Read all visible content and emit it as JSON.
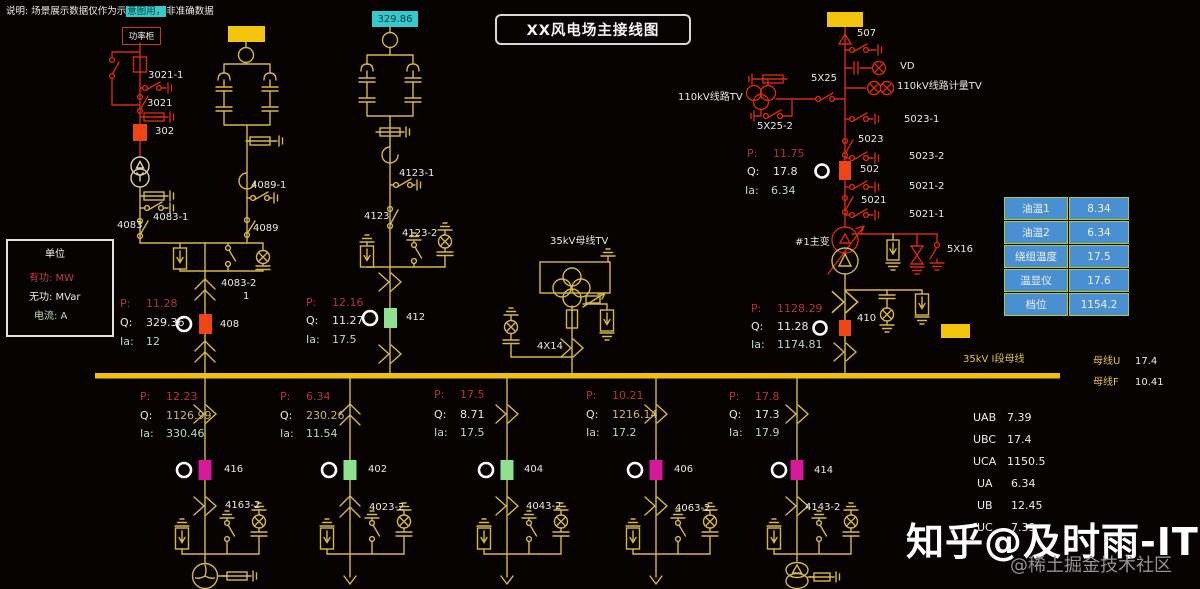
{
  "header": {
    "note_prefix": "说明: 场景展示数据仅作为示",
    "note_highlight": "意图用，",
    "note_suffix": "非准确数据",
    "title": "XX风电场主接线图",
    "capacitor_readout": "329.86",
    "power_cabinet": "功率柜"
  },
  "prefixes": {
    "p": "P:",
    "q": "Q:",
    "ia": "Ia:"
  },
  "legend": {
    "title": "单位",
    "active": "有功: MW",
    "reactive": "无功: MVar",
    "current": "电流: A"
  },
  "bay1": {
    "sw_3021_1": "3021-1",
    "sw_3021": "3021",
    "breaker_302": "302",
    "sw_4083": "4083",
    "sw_4083_1": "4083-1",
    "sw_4089_1": "4089-1",
    "sw_4089": "4089",
    "earth_4083_2": "4083-2",
    "tap": "1",
    "breaker_408": "408",
    "p": "11.28",
    "q": "329.36",
    "ia": "12"
  },
  "bay2": {
    "sw_4123_1": "4123-1",
    "sw_4123": "4123",
    "earth_4123_2": "4123-2",
    "breaker_412": "412",
    "p": "12.16",
    "q": "11.27",
    "ia": "17.5"
  },
  "tv_bay": {
    "label": "35kV母线TV",
    "reactor": "4X14"
  },
  "main_bay": {
    "sw_507": "507",
    "vd": "VD",
    "metering_tv": "110kV线路计量TV",
    "line_tv": "110kV线路TV",
    "sw_5x25": "5X25",
    "sw_5x25_2": "5X25-2",
    "sw_5023_1": "5023-1",
    "sw_5023": "5023",
    "sw_5023_2": "5023-2",
    "breaker_502": "502",
    "sw_5021_2": "5021-2",
    "sw_5021": "5021",
    "sw_5021_1": "5021-1",
    "transformer": "#1主变",
    "sw_5x16": "5X16",
    "breaker_410": "410",
    "p": "11.75",
    "q": "17.8",
    "ia": "6.34",
    "p2": "1128.29",
    "q2": "11.28",
    "ia2": "1174.81"
  },
  "transformer_table": {
    "rows": [
      {
        "label": "油温1",
        "value": "8.34"
      },
      {
        "label": "油温2",
        "value": "6.34"
      },
      {
        "label": "绕组温度",
        "value": "17.5"
      },
      {
        "label": "温显仪",
        "value": "17.6"
      },
      {
        "label": "档位",
        "value": "1154.2"
      }
    ]
  },
  "bus": {
    "name": "35kV I段母线",
    "u_label": "母线U",
    "u_value": "17.4",
    "f_label": "母线F",
    "f_value": "10.41"
  },
  "feeders": [
    {
      "p": "12.23",
      "q": "1126.99",
      "ia": "330.46",
      "breaker": "416",
      "disconnect": "4163-2"
    },
    {
      "p": "6.34",
      "q": "230.26",
      "ia": "11.54",
      "breaker": "402",
      "disconnect": "4023-2"
    },
    {
      "p": "17.5",
      "q": "8.71",
      "ia": "17.5",
      "breaker": "404",
      "disconnect": "4043-2"
    },
    {
      "p": "10.21",
      "q": "1216.14",
      "ia": "17.2",
      "breaker": "406",
      "disconnect": "4063-2"
    },
    {
      "p": "17.8",
      "q": "17.3",
      "ia": "17.9",
      "breaker": "414",
      "disconnect": "4143-2"
    }
  ],
  "voltages": [
    {
      "label": "UAB",
      "value": "7.39"
    },
    {
      "label": "UBC",
      "value": "17.4"
    },
    {
      "label": "UCA",
      "value": "1150.5"
    },
    {
      "label": "UA",
      "value": "6.34"
    },
    {
      "label": "UB",
      "value": "12.45"
    },
    {
      "label": "UC",
      "value": "7.39"
    }
  ],
  "watermark": {
    "line1": "知乎@及时雨-IT",
    "line2": "@稀土掘金技术社区"
  },
  "colors": {
    "wiring_yellow": "#d6b84a",
    "wiring_red": "#d22c12",
    "bus_yellow": "#f0c010",
    "breaker_orange": "#f04414",
    "breaker_green": "#8fe08f",
    "breaker_magenta": "#d6189a",
    "cyan_accent": "#35c8cc",
    "table_blue": "#4a8fd2",
    "table_border": "#b3c83e"
  }
}
